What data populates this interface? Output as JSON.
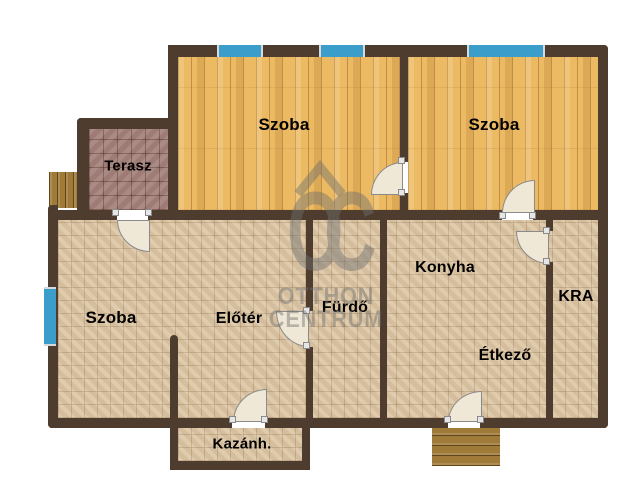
{
  "plan_title": "Floor plan",
  "rooms": {
    "szoba_top_left": "Szoba",
    "szoba_top_right": "Szoba",
    "terasz": "Terasz",
    "szoba_bottom": "Szoba",
    "eloter": "Előtér",
    "furdo": "Fürdő",
    "konyha": "Konyha",
    "etkezo": "Étkező",
    "kamra": "KRA",
    "kazanhaz": "Kazánh."
  },
  "watermark": {
    "logo": "OC",
    "name_line1": "OTTHON",
    "name_line2": "CENTRUM"
  },
  "colors": {
    "wall": "#4e3c2e",
    "wood_floor": "#ecba63",
    "tile_floor": "#ddc7a5",
    "terrace_tile": "#a5837c",
    "window_glass": "#3b9dc9",
    "door_leaf": "#efe8d6",
    "steps_wood": "#a07a38",
    "watermark_gray": "#6f6f6f"
  }
}
